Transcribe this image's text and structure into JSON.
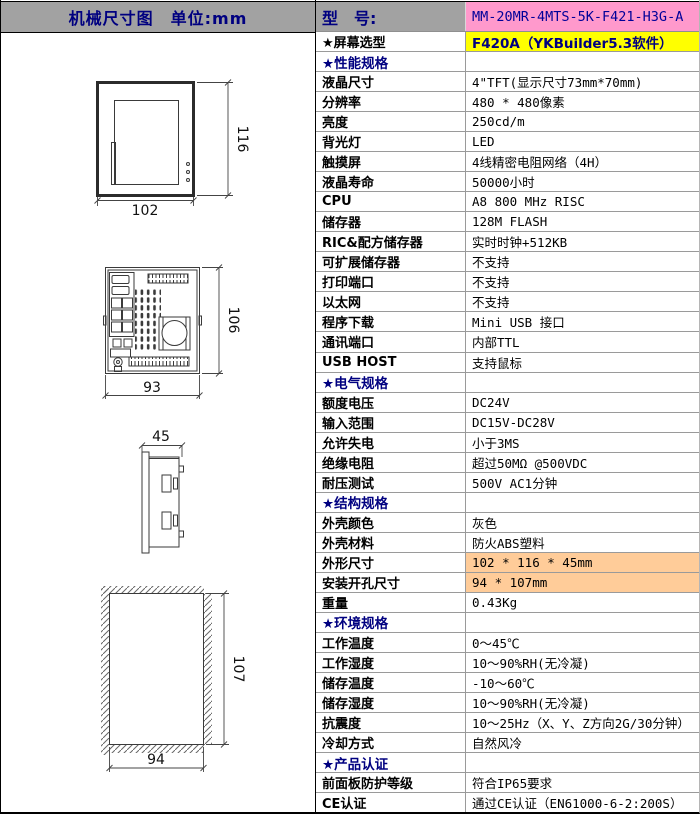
{
  "left_panel": {
    "title": "机械尺寸图　单位:mm"
  },
  "diagrams": {
    "front": {
      "width_label": "102",
      "height_label": "116"
    },
    "rear": {
      "width_label": "93",
      "height_label": "106"
    },
    "side": {
      "depth_label": "45"
    },
    "cutout": {
      "width_label": "94",
      "height_label": "107"
    }
  },
  "table": {
    "model_label": "型　号:",
    "model_value": "MM-20MR-4MTS-5K-F421-H3G-A",
    "rows": [
      {
        "label": "★屏幕选型",
        "value": "F420A（YKBuilder5.3软件）",
        "type": "yellow"
      },
      {
        "label": "★性能规格",
        "value": "",
        "type": "section"
      },
      {
        "label": "液晶尺寸",
        "value": "4\"TFT(显示尺寸73mm*70mm)",
        "type": "normal"
      },
      {
        "label": "分辨率",
        "value": "480 * 480像素",
        "type": "normal"
      },
      {
        "label": "亮度",
        "value": "250cd/m",
        "type": "normal"
      },
      {
        "label": "背光灯",
        "value": "LED",
        "type": "normal"
      },
      {
        "label": "触摸屏",
        "value": "4线精密电阻网络（4H）",
        "type": "normal"
      },
      {
        "label": "液晶寿命",
        "value": "50000小时",
        "type": "normal"
      },
      {
        "label": "CPU",
        "value": "A8 800 MHz RISC",
        "type": "normal"
      },
      {
        "label": "储存器",
        "value": "128M FLASH",
        "type": "normal"
      },
      {
        "label": "RIC&配方储存器",
        "value": "实时时钟+512KB",
        "type": "normal"
      },
      {
        "label": "可扩展储存器",
        "value": "不支持",
        "type": "normal"
      },
      {
        "label": "打印端口",
        "value": "不支持",
        "type": "normal"
      },
      {
        "label": "以太网",
        "value": "不支持",
        "type": "normal"
      },
      {
        "label": "程序下载",
        "value": "Mini USB 接口",
        "type": "normal"
      },
      {
        "label": "通讯端口",
        "value": "内部TTL",
        "type": "normal"
      },
      {
        "label": "USB HOST",
        "value": "支持鼠标",
        "type": "normal"
      },
      {
        "label": "★电气规格",
        "value": "",
        "type": "section"
      },
      {
        "label": "额度电压",
        "value": "DC24V",
        "type": "normal"
      },
      {
        "label": "输入范围",
        "value": "DC15V-DC28V",
        "type": "normal"
      },
      {
        "label": "允许失电",
        "value": "小于3MS",
        "type": "normal"
      },
      {
        "label": "绝缘电阻",
        "value": "超过50MΩ @500VDC",
        "type": "normal"
      },
      {
        "label": "耐压测试",
        "value": "500V AC1分钟",
        "type": "normal"
      },
      {
        "label": "★结构规格",
        "value": "",
        "type": "section"
      },
      {
        "label": "外壳颜色",
        "value": "灰色",
        "type": "normal"
      },
      {
        "label": "外壳材料",
        "value": "防火ABS塑料",
        "type": "normal"
      },
      {
        "label": "外形尺寸",
        "value": "102 * 116 * 45mm",
        "type": "orange"
      },
      {
        "label": "安装开孔尺寸",
        "value": "94 * 107mm",
        "type": "orange"
      },
      {
        "label": "重量",
        "value": "0.43Kg",
        "type": "normal"
      },
      {
        "label": "★环境规格",
        "value": "",
        "type": "section"
      },
      {
        "label": "工作温度",
        "value": "0～45℃",
        "type": "normal"
      },
      {
        "label": "工作湿度",
        "value": "10～90%RH(无冷凝)",
        "type": "normal"
      },
      {
        "label": "储存温度",
        "value": "-10～60℃",
        "type": "normal"
      },
      {
        "label": "储存湿度",
        "value": "10～90%RH(无冷凝)",
        "type": "normal"
      },
      {
        "label": "抗震度",
        "value": "10～25Hz（X、Y、Z方向2G/30分钟）",
        "type": "normal"
      },
      {
        "label": "冷却方式",
        "value": "自然风冷",
        "type": "normal"
      },
      {
        "label": "★产品认证",
        "value": "",
        "type": "section"
      },
      {
        "label": "前面板防护等级",
        "value": "符合IP65要求",
        "type": "normal"
      },
      {
        "label": "CE认证",
        "value": "通过CE认证（EN61000-6-2:200S）",
        "type": "normal"
      }
    ]
  },
  "colors": {
    "header_gray": "#a2a2a2",
    "model_pink": "#ff99cc",
    "screen_yellow": "#ffff00",
    "dimension_orange": "#ffcc99",
    "accent_navy": "#000080"
  }
}
